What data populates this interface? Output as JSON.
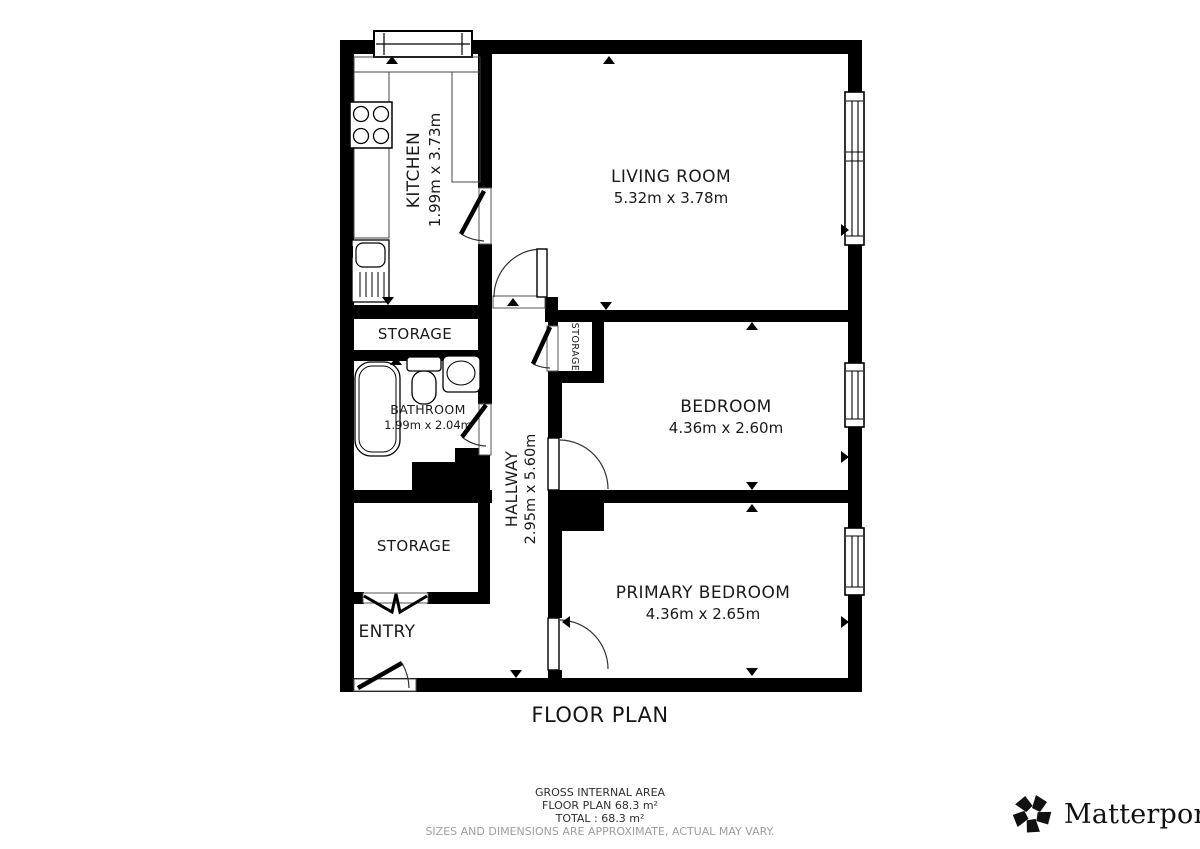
{
  "title": "FLOOR PLAN",
  "rooms": {
    "kitchen": {
      "name": "KITCHEN",
      "dims": "1.99m x 3.73m"
    },
    "living_room": {
      "name": "LIVING ROOM",
      "dims": "5.32m x 3.78m"
    },
    "bedroom": {
      "name": "BEDROOM",
      "dims": "4.36m x 2.60m"
    },
    "primary_bedroom": {
      "name": "PRIMARY BEDROOM",
      "dims": "4.36m x 2.65m"
    },
    "bathroom": {
      "name": "BATHROOM",
      "dims": "1.99m x 2.04m"
    },
    "hallway": {
      "name": "HALLWAY",
      "dims": "2.95m x 5.60m"
    },
    "storage_upper": {
      "name": "STORAGE"
    },
    "storage_lower": {
      "name": "STORAGE"
    },
    "storage_closet": {
      "name": "STORAGE"
    },
    "entry": {
      "name": "ENTRY"
    }
  },
  "footer": {
    "area_heading": "GROSS INTERNAL AREA",
    "floor_area": "FLOOR PLAN 68.3 m²",
    "total": "TOTAL :  68.3 m²",
    "disclaimer": "SIZES AND DIMENSIONS ARE APPROXIMATE, ACTUAL MAY VARY."
  },
  "branding": {
    "logo_text": "Matterport",
    "registered_mark": "®"
  },
  "colors": {
    "walls": "#000000",
    "text": "#1a1a1a",
    "disclaimer": "#9e9e9e",
    "background": "#ffffff"
  }
}
